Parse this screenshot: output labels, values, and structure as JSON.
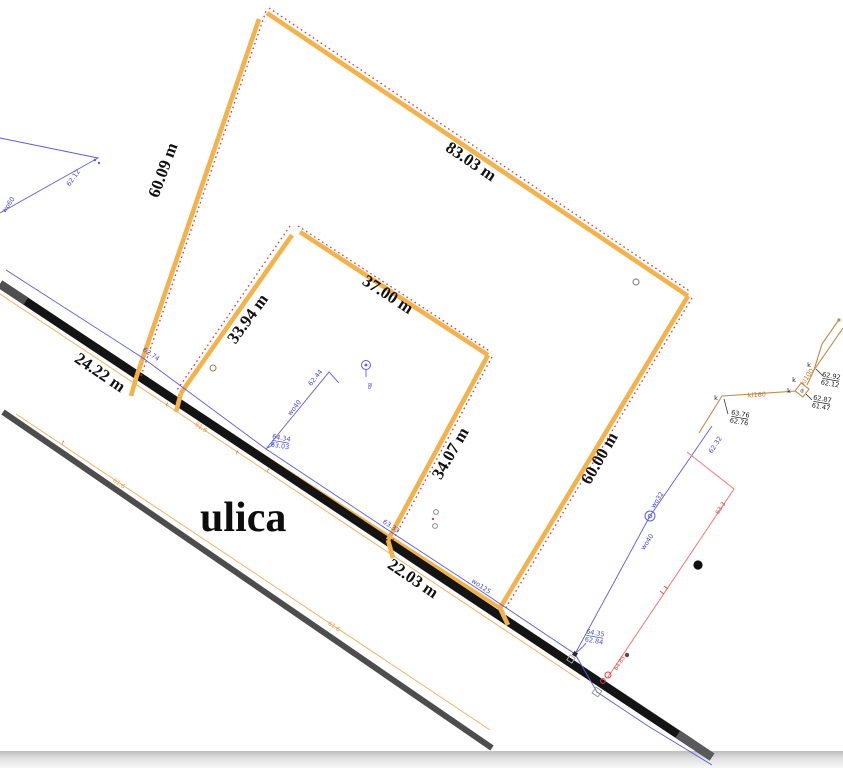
{
  "street": {
    "name": "ulica"
  },
  "dimensions": {
    "side_nw": "60.09 m",
    "side_ne": "83.03 m",
    "inner_ne": "37.00 m",
    "inner_nw": "33.94 m",
    "inner_se": "34.07 m",
    "side_se": "60.00 m",
    "frontage_w": "24.22 m",
    "frontage_e": "22.03 m"
  },
  "survey": {
    "tl_elev": "62.12",
    "tl_point": "wo60",
    "road_elev_1": "62.74",
    "pair1_top": "64.34",
    "pair1_bot": "63.03",
    "branch_point": "wo40",
    "branch_elev": "62.44",
    "pole_tag": "8b",
    "road_elev_2": "63.33",
    "road_point": "wo125",
    "right_elev": "62.32",
    "right_pole": "wo32",
    "right_point": "wo40",
    "pair2_top": "64.35",
    "pair2_bot": "62.84"
  },
  "power": {
    "elev": "63.3",
    "end_elev": "64.85"
  },
  "utility": {
    "marker_k": "k",
    "marker_d": "d",
    "pipe_main": "kl160",
    "pipe_branch": "kl100",
    "pair1_top": "63.76",
    "pair1_bot": "62.76",
    "pair2_top": "62.92",
    "pair2_bot": "62.12",
    "pair3_top": "62.87",
    "pair3_bot": "61.47"
  },
  "street_profile": {
    "elev": "61.6",
    "tick": "t"
  },
  "colors": {
    "parcel_boundary": "#f3b24b",
    "boundary_dots": "#e23535",
    "survey_blue": "#5b5bde",
    "utility_brown": "#c4884c",
    "power_red": "#f08080",
    "road_black": "#141414",
    "road_gray": "#4d4d4d",
    "street_thin_orange": "#f0b168"
  }
}
